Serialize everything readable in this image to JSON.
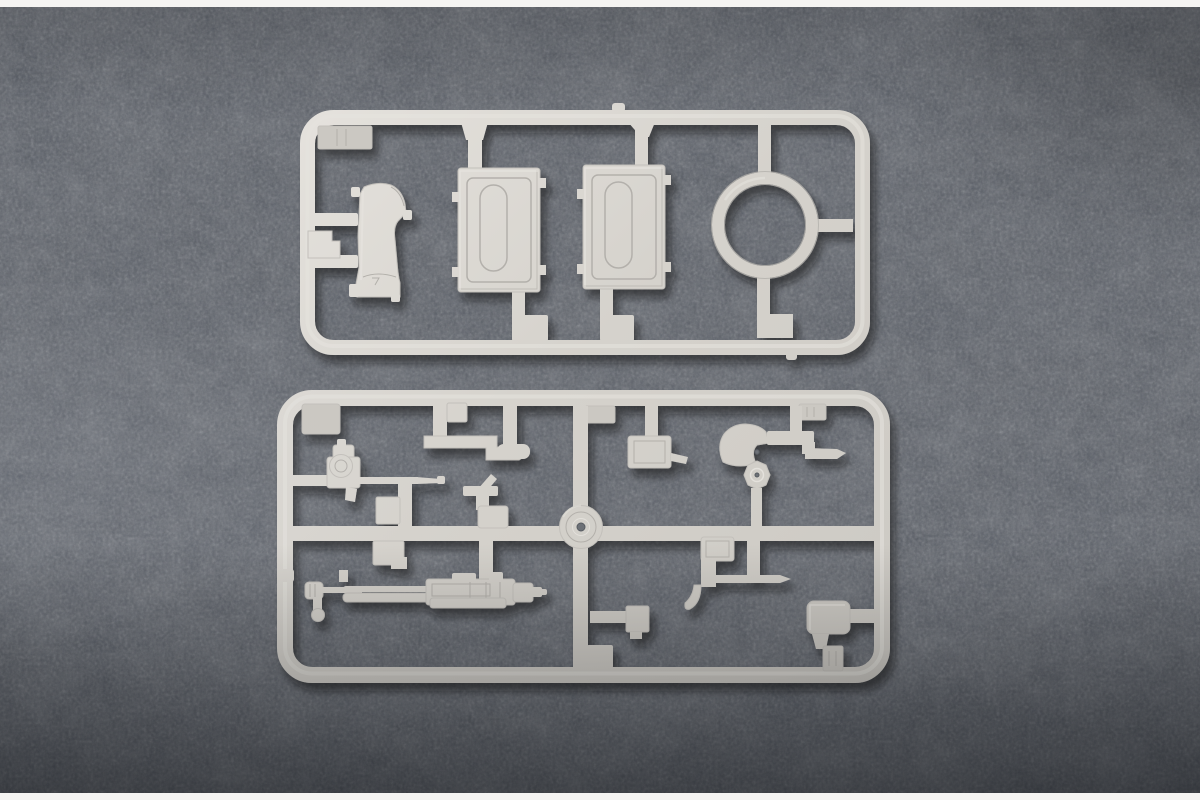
{
  "photo": {
    "description": "Top-down product photograph of two light gray injection-molded plastic model kit sprues (part runners) lying on a dark gray mottled felt mat, with thin white strips along the top and bottom edges of the image.",
    "sprues": [
      {
        "name": "upper-sprue",
        "shape": "rounded rectangular runner frame",
        "parts": [
          "ridged-mounting-tab",
          "curved-housing",
          "rectangular-hatch-left",
          "rectangular-hatch-right",
          "large-ring"
        ]
      },
      {
        "name": "lower-sprue",
        "shape": "rounded rectangular runner frame with mid cross-runner",
        "parts": [
          "large-corner-tab",
          "stepped-pipe-bracket",
          "small-box-top",
          "light-machine-gun",
          "blade-post-bracket",
          "small-boxes-center",
          "cable-reel-pulley",
          "latch-box-with-hook",
          "fan-shaped-bracket",
          "octagonal-hub",
          "heavy-machine-gun",
          "hooked-lever-with-rod",
          "stowage-box-right",
          "ridged-tab-top",
          "ridged-tab-bottom"
        ]
      }
    ]
  },
  "colors": {
    "background_base": "#545962",
    "background_dark": "#3a3e45",
    "background_light": "#7a7f88",
    "plastic_light": "#e6e3de",
    "plastic_base": "#d5d2cc",
    "plastic_dim": "#cbc8c2",
    "plastic_shadow": "#b3b0ab",
    "plastic_edge": "#c3c0bb",
    "hole_dark": "#6d7177",
    "border_strip": "#f5f4f2",
    "cast_shadow": "#0c0e12"
  }
}
